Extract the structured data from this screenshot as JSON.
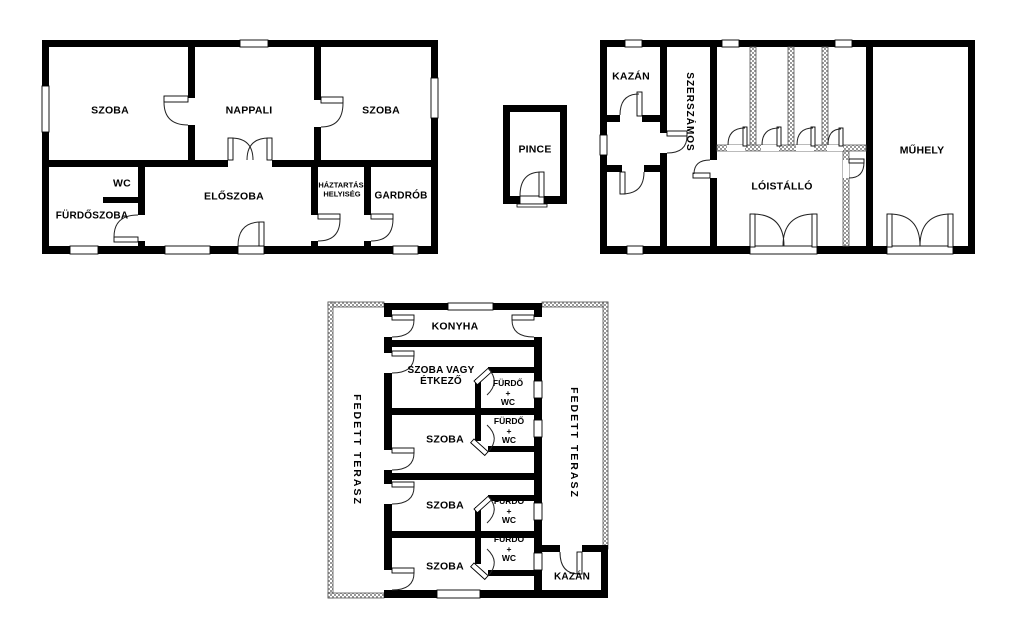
{
  "figure": {
    "type": "floor-plan",
    "background_color": "#ffffff",
    "wall_color": "#000000",
    "hatch_color": "#999999",
    "line_color": "#222222"
  },
  "house_top_left": {
    "szoba_left": "SZOBA",
    "nappali": "NAPPALI",
    "szoba_right": "SZOBA",
    "wc": "WC",
    "furdoszoba": "FÜRDŐSZOBA",
    "eloszoba": "ELŐSZOBA",
    "haztartasi_line1": "HÁZTARTÁSI",
    "haztartasi_line2": "HELYISÉG",
    "gardrob": "GARDRÓB"
  },
  "cellar": {
    "pince": "PINCE"
  },
  "outbuilding_top_right": {
    "kazan": "KAZÁN",
    "szerszamos": "SZERSZÁMOS",
    "loistallo": "LÓISTÁLLÓ",
    "muhely": "MŰHELY"
  },
  "guest_house_bottom": {
    "konyha": "KONYHA",
    "szoba_vagy_etkezo_line1": "SZOBA VAGY",
    "szoba_vagy_etkezo_line2": "ÉTKEZŐ",
    "szoba": "SZOBA",
    "furdo_line1": "FÜRDŐ",
    "furdo_line2": "+",
    "furdo_line3": "WC",
    "fedett_terasz": "FEDETT TERASZ",
    "kazan": "KAZÁN"
  }
}
